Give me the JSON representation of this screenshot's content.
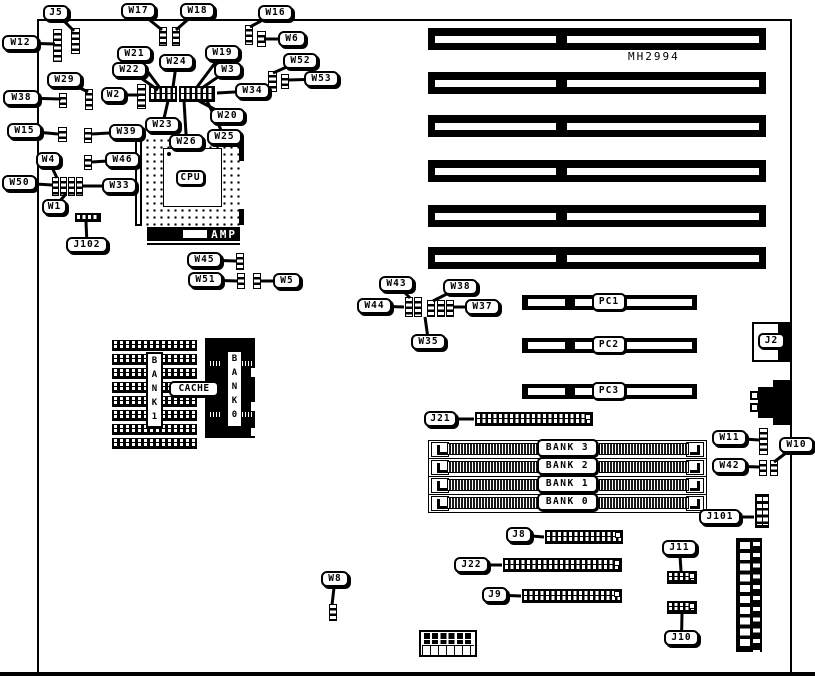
{
  "board": {
    "part_number": "MH2994"
  },
  "cpu": {
    "label": "CPU",
    "brand": "AMP"
  },
  "cache": {
    "label": "CACHE",
    "bank1_vertical": "BANK1",
    "bank0_vertical": "BANK0"
  },
  "io": {
    "j2_label": "J2"
  },
  "isa_slots": {
    "x": 428,
    "w": 338,
    "h": 22,
    "ys": [
      28,
      72,
      115,
      160,
      205,
      247
    ]
  },
  "pci_slots": [
    {
      "label": "PC1",
      "y": 295
    },
    {
      "label": "PC2",
      "y": 338
    },
    {
      "label": "PC3",
      "y": 384
    }
  ],
  "memory_banks": [
    {
      "label": "BANK 3",
      "y": 440
    },
    {
      "label": "BANK 2",
      "y": 458
    },
    {
      "label": "BANK 1",
      "y": 476
    },
    {
      "label": "BANK 0",
      "y": 494
    }
  ],
  "callouts": [
    {
      "id": "j5",
      "text": "J5",
      "x": 43,
      "y": 5,
      "w": 26,
      "tx": 74,
      "ty": 31
    },
    {
      "id": "w12",
      "text": "W12",
      "x": 2,
      "y": 35,
      "w": 37,
      "tx": 55,
      "ty": 44
    },
    {
      "id": "w17",
      "text": "W17",
      "x": 121,
      "y": 3,
      "w": 35,
      "tx": 162,
      "ty": 30
    },
    {
      "id": "w18",
      "text": "W18",
      "x": 180,
      "y": 3,
      "w": 35,
      "tx": 176,
      "ty": 30
    },
    {
      "id": "w16",
      "text": "W16",
      "x": 258,
      "y": 5,
      "w": 35,
      "tx": 250,
      "ty": 27
    },
    {
      "id": "w6",
      "text": "W6",
      "x": 278,
      "y": 31,
      "w": 28,
      "tx": 264,
      "ty": 39
    },
    {
      "id": "w52",
      "text": "W52",
      "x": 283,
      "y": 53,
      "w": 35,
      "tx": 273,
      "ty": 73
    },
    {
      "id": "w53",
      "text": "W53",
      "x": 304,
      "y": 71,
      "w": 35,
      "tx": 288,
      "ty": 80
    },
    {
      "id": "w29",
      "text": "W29",
      "x": 47,
      "y": 72,
      "w": 35,
      "tx": 88,
      "ty": 92
    },
    {
      "id": "w38",
      "text": "W38",
      "x": 3,
      "y": 90,
      "w": 37,
      "tx": 61,
      "ty": 99
    },
    {
      "id": "w2",
      "text": "W2",
      "x": 101,
      "y": 87,
      "w": 25,
      "tx": 139,
      "ty": 95
    },
    {
      "id": "w21",
      "text": "W21",
      "x": 117,
      "y": 46,
      "w": 35,
      "tx": 160,
      "ty": 88
    },
    {
      "id": "w22",
      "text": "W22",
      "x": 112,
      "y": 62,
      "w": 35,
      "tx": 158,
      "ty": 90
    },
    {
      "id": "w24",
      "text": "W24",
      "x": 159,
      "y": 54,
      "w": 35,
      "tx": 173,
      "ty": 87
    },
    {
      "id": "w19",
      "text": "W19",
      "x": 205,
      "y": 45,
      "w": 35,
      "tx": 197,
      "ty": 87
    },
    {
      "id": "w3",
      "text": "W3",
      "x": 214,
      "y": 62,
      "w": 28,
      "tx": 202,
      "ty": 88
    },
    {
      "id": "w34",
      "text": "W34",
      "x": 235,
      "y": 83,
      "w": 35,
      "tx": 217,
      "ty": 93
    },
    {
      "id": "w20",
      "text": "W20",
      "x": 210,
      "y": 108,
      "w": 35,
      "tx": 199,
      "ty": 101
    },
    {
      "id": "w23",
      "text": "W23",
      "x": 145,
      "y": 117,
      "w": 35,
      "tx": 168,
      "ty": 101
    },
    {
      "id": "w25",
      "text": "W25",
      "x": 207,
      "y": 129,
      "w": 35,
      "tx": 207,
      "ty": 101
    },
    {
      "id": "w26",
      "text": "W26",
      "x": 169,
      "y": 134,
      "w": 35,
      "tx": 184,
      "ty": 101
    },
    {
      "id": "w39",
      "text": "W39",
      "x": 109,
      "y": 124,
      "w": 35,
      "tx": 92,
      "ty": 134
    },
    {
      "id": "w15",
      "text": "W15",
      "x": 7,
      "y": 123,
      "w": 35,
      "tx": 58,
      "ty": 134
    },
    {
      "id": "w4",
      "text": "W4",
      "x": 36,
      "y": 152,
      "w": 25,
      "tx": 57,
      "ty": 178
    },
    {
      "id": "w46",
      "text": "W46",
      "x": 105,
      "y": 152,
      "w": 35,
      "tx": 92,
      "ty": 162
    },
    {
      "id": "w50",
      "text": "W50",
      "x": 2,
      "y": 175,
      "w": 35,
      "tx": 52,
      "ty": 185
    },
    {
      "id": "w33",
      "text": "W33",
      "x": 102,
      "y": 178,
      "w": 35,
      "tx": 83,
      "ty": 186
    },
    {
      "id": "w1",
      "text": "W1",
      "x": 42,
      "y": 199,
      "w": 25,
      "tx": 66,
      "ty": 194
    },
    {
      "id": "j102",
      "text": "J102",
      "x": 66,
      "y": 237,
      "w": 42,
      "tx": 86,
      "ty": 222
    },
    {
      "id": "w45",
      "text": "W45",
      "x": 187,
      "y": 252,
      "w": 35,
      "tx": 236,
      "ty": 261
    },
    {
      "id": "w51",
      "text": "W51",
      "x": 188,
      "y": 272,
      "w": 35,
      "tx": 237,
      "ty": 281
    },
    {
      "id": "w5",
      "text": "W5",
      "x": 273,
      "y": 273,
      "w": 28,
      "tx": 261,
      "ty": 281
    },
    {
      "id": "w43",
      "text": "W43",
      "x": 379,
      "y": 276,
      "w": 35,
      "tx": 410,
      "ty": 298
    },
    {
      "id": "w38b",
      "text": "W38",
      "x": 443,
      "y": 279,
      "w": 35,
      "tx": 433,
      "ty": 301
    },
    {
      "id": "w44",
      "text": "W44",
      "x": 357,
      "y": 298,
      "w": 35,
      "tx": 404,
      "ty": 307
    },
    {
      "id": "w37",
      "text": "W37",
      "x": 465,
      "y": 299,
      "w": 35,
      "tx": 454,
      "ty": 307
    },
    {
      "id": "w35",
      "text": "W35",
      "x": 411,
      "y": 334,
      "w": 35,
      "tx": 425,
      "ty": 317
    },
    {
      "id": "w8",
      "text": "W8",
      "x": 321,
      "y": 571,
      "w": 28,
      "tx": 332,
      "ty": 605
    },
    {
      "id": "j21",
      "text": "J21",
      "x": 424,
      "y": 411,
      "w": 33,
      "tx": 474,
      "ty": 419
    },
    {
      "id": "w11",
      "text": "W11",
      "x": 712,
      "y": 430,
      "w": 35,
      "tx": 759,
      "ty": 440
    },
    {
      "id": "w10",
      "text": "W10",
      "x": 779,
      "y": 437,
      "w": 35,
      "tx": 774,
      "ty": 462
    },
    {
      "id": "w42",
      "text": "W42",
      "x": 712,
      "y": 458,
      "w": 35,
      "tx": 759,
      "ty": 467
    },
    {
      "id": "j101",
      "text": "J101",
      "x": 699,
      "y": 509,
      "w": 42,
      "tx": 754,
      "ty": 517
    },
    {
      "id": "j8",
      "text": "J8",
      "x": 506,
      "y": 527,
      "w": 26,
      "tx": 544,
      "ty": 537
    },
    {
      "id": "j22",
      "text": "J22",
      "x": 454,
      "y": 557,
      "w": 35,
      "tx": 502,
      "ty": 565
    },
    {
      "id": "j9",
      "text": "J9",
      "x": 482,
      "y": 587,
      "w": 26,
      "tx": 521,
      "ty": 596
    },
    {
      "id": "j11",
      "text": "J11",
      "x": 662,
      "y": 540,
      "w": 35,
      "tx": 681,
      "ty": 571
    },
    {
      "id": "j10",
      "text": "J10",
      "x": 664,
      "y": 630,
      "w": 35,
      "tx": 682,
      "ty": 614
    }
  ],
  "jumpers": [
    {
      "id": "j5-jumper",
      "x": 71,
      "y": 28,
      "w": 9,
      "h": 26
    },
    {
      "id": "w12-jumper",
      "x": 53,
      "y": 29,
      "w": 9,
      "h": 33
    },
    {
      "id": "w17-jumper",
      "x": 159,
      "y": 27,
      "w": 8,
      "h": 19
    },
    {
      "id": "w18-jumper",
      "x": 172,
      "y": 27,
      "w": 8,
      "h": 19
    },
    {
      "id": "w16-jumper",
      "x": 245,
      "y": 25,
      "w": 8,
      "h": 20
    },
    {
      "id": "w6-jumper",
      "x": 257,
      "y": 31,
      "w": 9,
      "h": 16
    },
    {
      "id": "w52-jumper",
      "x": 268,
      "y": 71,
      "w": 9,
      "h": 21
    },
    {
      "id": "w53-jumper",
      "x": 281,
      "y": 74,
      "w": 8,
      "h": 15
    },
    {
      "id": "w29-jumper",
      "x": 85,
      "y": 89,
      "w": 8,
      "h": 21
    },
    {
      "id": "w38-jumper",
      "x": 59,
      "y": 93,
      "w": 8,
      "h": 15
    },
    {
      "id": "w2-jumper",
      "x": 137,
      "y": 84,
      "w": 9,
      "h": 25
    },
    {
      "id": "w15-jumper",
      "x": 58,
      "y": 127,
      "w": 9,
      "h": 15
    },
    {
      "id": "w39-jumper",
      "x": 84,
      "y": 128,
      "w": 8,
      "h": 15
    },
    {
      "id": "w46-jumper",
      "x": 84,
      "y": 155,
      "w": 8,
      "h": 15
    },
    {
      "id": "w50-jumper-1",
      "x": 52,
      "y": 177,
      "w": 7,
      "h": 19
    },
    {
      "id": "w50-jumper-2",
      "x": 60,
      "y": 177,
      "w": 7,
      "h": 19
    },
    {
      "id": "w50-jumper-3",
      "x": 68,
      "y": 177,
      "w": 7,
      "h": 19
    },
    {
      "id": "w50-jumper-4",
      "x": 76,
      "y": 177,
      "w": 7,
      "h": 19
    },
    {
      "id": "w45-jumper",
      "x": 236,
      "y": 253,
      "w": 8,
      "h": 17
    },
    {
      "id": "w51-jumper",
      "x": 237,
      "y": 273,
      "w": 8,
      "h": 16
    },
    {
      "id": "w5-jumper",
      "x": 253,
      "y": 273,
      "w": 8,
      "h": 16
    },
    {
      "id": "w44-jumper",
      "x": 405,
      "y": 297,
      "w": 8,
      "h": 20
    },
    {
      "id": "w43-jumper",
      "x": 414,
      "y": 297,
      "w": 8,
      "h": 20
    },
    {
      "id": "w35-jumper",
      "x": 427,
      "y": 300,
      "w": 8,
      "h": 17
    },
    {
      "id": "w38b-jumper",
      "x": 437,
      "y": 300,
      "w": 8,
      "h": 17
    },
    {
      "id": "w37-jumper",
      "x": 446,
      "y": 300,
      "w": 8,
      "h": 17
    },
    {
      "id": "w8-jumper",
      "x": 329,
      "y": 604,
      "w": 8,
      "h": 17
    },
    {
      "id": "w11-jumper",
      "x": 759,
      "y": 428,
      "w": 9,
      "h": 27
    },
    {
      "id": "w42-jumper",
      "x": 759,
      "y": 460,
      "w": 8,
      "h": 16
    },
    {
      "id": "w10-jumper",
      "x": 770,
      "y": 460,
      "w": 8,
      "h": 16
    }
  ],
  "pin_strips": [
    {
      "id": "jblock-left",
      "x": 149,
      "y": 86,
      "w": 28,
      "h": 16,
      "type": "h2",
      "marker": false
    },
    {
      "id": "jblock-right",
      "x": 179,
      "y": 86,
      "w": 36,
      "h": 16,
      "type": "h2",
      "marker": false
    },
    {
      "id": "j102-conn",
      "x": 75,
      "y": 213,
      "w": 26,
      "h": 9,
      "type": "h1",
      "marker": false
    },
    {
      "id": "j21-conn",
      "x": 475,
      "y": 412,
      "w": 118,
      "h": 14,
      "type": "h2",
      "marker": true
    },
    {
      "id": "j8-conn",
      "x": 545,
      "y": 530,
      "w": 78,
      "h": 14,
      "type": "h2",
      "marker": true
    },
    {
      "id": "j22-conn",
      "x": 503,
      "y": 558,
      "w": 119,
      "h": 14,
      "type": "h2",
      "marker": true
    },
    {
      "id": "j9-conn",
      "x": 522,
      "y": 589,
      "w": 100,
      "h": 14,
      "type": "h2",
      "marker": true
    },
    {
      "id": "j11-conn",
      "x": 667,
      "y": 571,
      "w": 30,
      "h": 13,
      "type": "h2",
      "marker": true
    },
    {
      "id": "j10-conn",
      "x": 667,
      "y": 601,
      "w": 30,
      "h": 13,
      "type": "h2",
      "marker": true
    },
    {
      "id": "j101-conn",
      "x": 755,
      "y": 494,
      "w": 14,
      "h": 34,
      "type": "v2",
      "marker": false
    }
  ]
}
